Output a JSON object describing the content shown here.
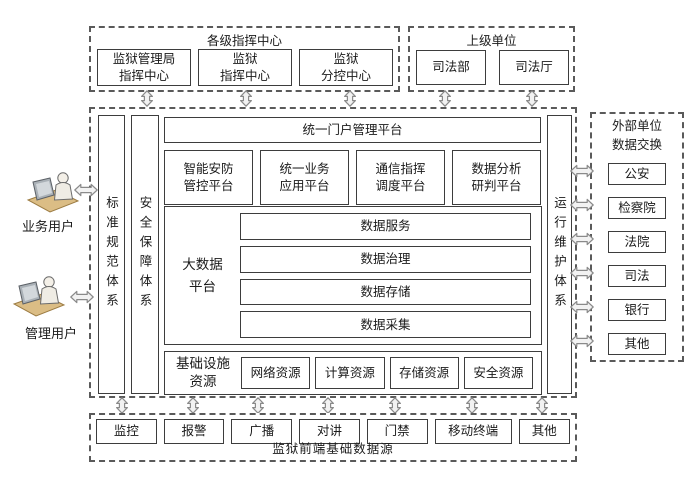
{
  "colors": {
    "background": "#ffffff",
    "box_border": "#3d3d3d",
    "dashed_border": "#5a5a5a",
    "arrow_outline": "#8a8a8a",
    "arrow_fill": "#f2f2f2",
    "desk_tan": "#dbbd85",
    "monitor_gray": "#aab1b7",
    "text": "#1a1a1a"
  },
  "icons": {
    "user": "workstation-icon",
    "vertical_link": "double-arrow-vertical-icon",
    "horizontal_link": "double-arrow-horizontal-icon"
  },
  "users": [
    {
      "label": "业务用户"
    },
    {
      "label": "管理用户"
    }
  ],
  "top_command": {
    "title": "各级指挥中心",
    "items": [
      "监狱管理局\n指挥中心",
      "监狱\n指挥中心",
      "监狱\n分控中心"
    ]
  },
  "top_superior": {
    "title": "上级单位",
    "items": [
      "司法部",
      "司法厅"
    ]
  },
  "pillars": {
    "left": [
      "标准规范体系",
      "安全保障体系"
    ],
    "right": "运行维护体系"
  },
  "portal_label": "统一门户管理平台",
  "platforms": [
    "智能安防\n管控平台",
    "统一业务\n应用平台",
    "通信指挥\n调度平台",
    "数据分析\n研判平台"
  ],
  "bigdata": {
    "label": "大数据\n平台",
    "layers": [
      "数据服务",
      "数据治理",
      "数据存储",
      "数据采集"
    ]
  },
  "infra": {
    "label": "基础设施\n资源",
    "items": [
      "网络资源",
      "计算资源",
      "存储资源",
      "安全资源"
    ]
  },
  "external": {
    "title": "外部单位\n数据交换",
    "items": [
      "公安",
      "检察院",
      "法院",
      "司法",
      "银行",
      "其他"
    ]
  },
  "frontend": {
    "title": "监狱前端基础数据源",
    "items": [
      "监控",
      "报警",
      "广播",
      "对讲",
      "门禁",
      "移动终端",
      "其他"
    ]
  }
}
